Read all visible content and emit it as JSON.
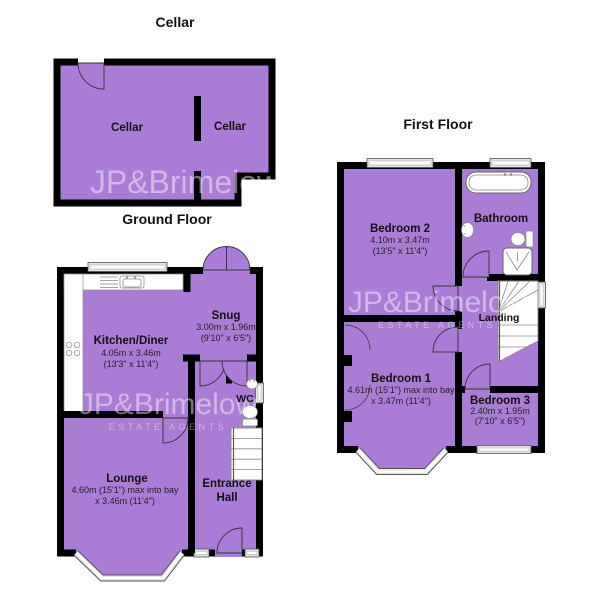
{
  "watermark": {
    "line1": "JP&Brimelow",
    "line2": "ESTATE AGENTS"
  },
  "colors": {
    "room_fill": "#a97dd6",
    "wall": "#000000",
    "window_fill": "#e3e3e3"
  },
  "cellar": {
    "title": "Cellar",
    "room_left": "Cellar",
    "room_right": "Cellar"
  },
  "ground_floor": {
    "title": "Ground Floor",
    "kitchen": {
      "name": "Kitchen/Diner",
      "dims_metric": "4.05m x 3.46m",
      "dims_imperial": "(13'3\" x 11'4\")"
    },
    "snug": {
      "name": "Snug",
      "dims_metric": "3.00m x 1.96m",
      "dims_imperial": "(9'10\" x 6'5\")"
    },
    "wc": {
      "name": "WC"
    },
    "entrance_hall": {
      "name_line1": "Entrance",
      "name_line2": "Hall"
    },
    "lounge": {
      "name": "Lounge",
      "dims_line1": "4.60m (15'1\") max into bay",
      "dims_line2": "x 3.46m (11'4\")"
    }
  },
  "first_floor": {
    "title": "First Floor",
    "bedroom2": {
      "name": "Bedroom 2",
      "dims_metric": "4.10m x 3.47m",
      "dims_imperial": "(13'5\" x 11'4\")"
    },
    "bathroom": {
      "name": "Bathroom"
    },
    "landing": {
      "name": "Landing"
    },
    "bedroom1": {
      "name": "Bedroom 1",
      "dims_line1": "4.61m (15'1\") max into bay",
      "dims_line2": "x 3.47m (11'4\")"
    },
    "bedroom3": {
      "name": "Bedroom 3",
      "dims_metric": "2.40m x 1.95m",
      "dims_imperial": "(7'10\" x 6'5\")"
    }
  }
}
